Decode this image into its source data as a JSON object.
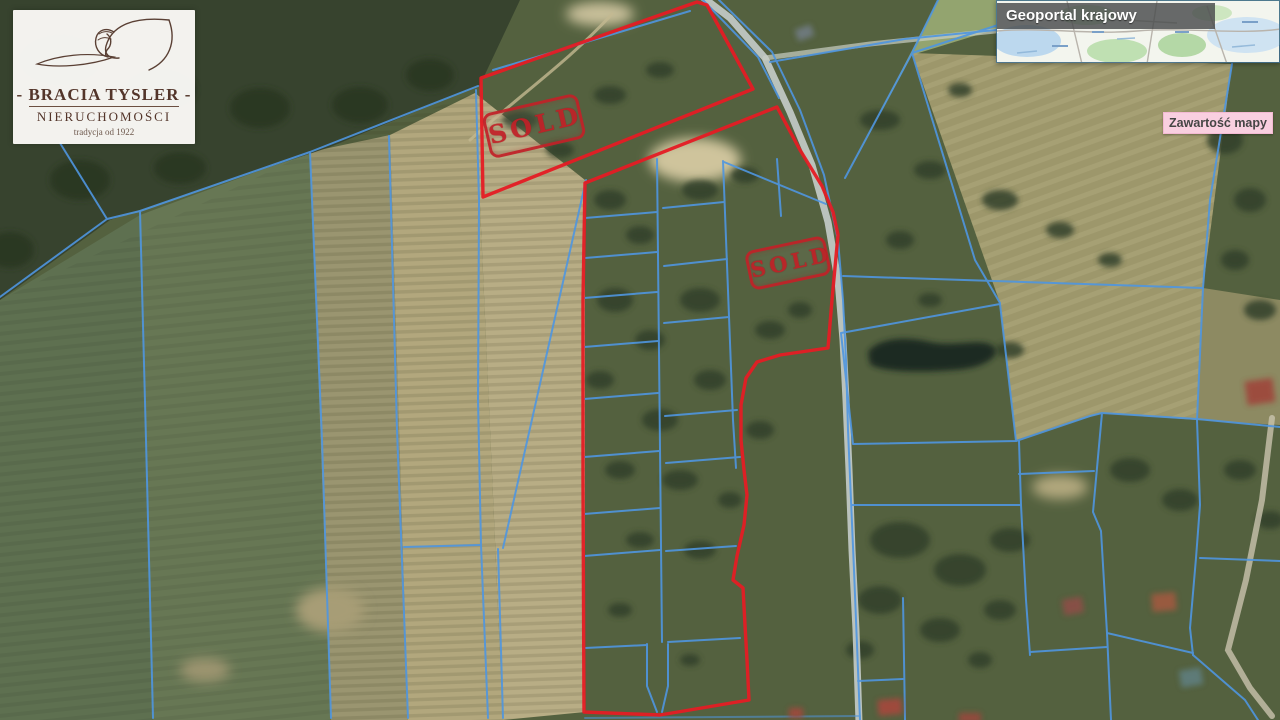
{
  "branding": {
    "name_line": "- BRACIA TYSLER -",
    "subtitle_line": "NIERUCHOMOŚCI",
    "tagline": "tradycja od 1922"
  },
  "geoportal_panel": {
    "title": "Geoportal krajowy"
  },
  "legend_toggle": {
    "label": "Zawartość mapy"
  },
  "stamps": [
    {
      "label": "SOLD"
    },
    {
      "label": "SOLD"
    }
  ],
  "colors": {
    "parcel_line_blue": "#4f96e0",
    "boundary_red": "#e51c24",
    "stamp_red": "#c22128",
    "legend_pink": "#f9cfe0",
    "panel_header_grey": "#484a4c",
    "road_pale": "#ccd4d2",
    "pond_dark": "#1c2b24"
  }
}
